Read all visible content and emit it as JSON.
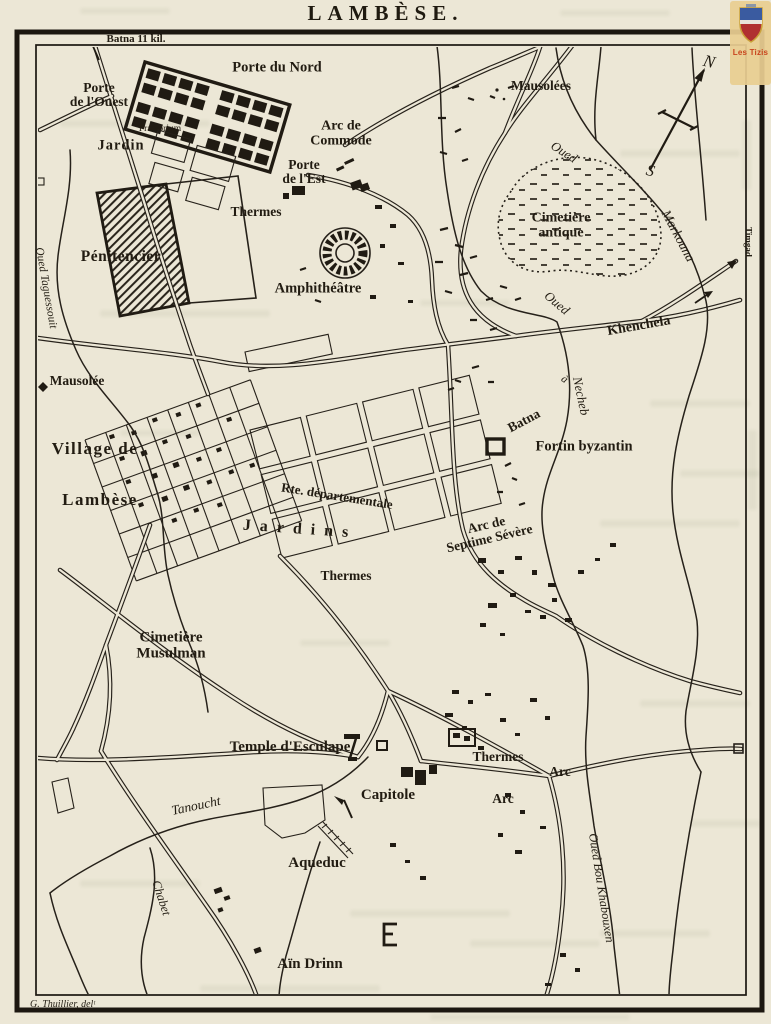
{
  "page": {
    "title": "LAMBÈSE.",
    "credit": "G. Thuillier, delᵗ",
    "watermark": {
      "text": "Les Tizis"
    },
    "colors": {
      "paper": "#ece7d6",
      "ink": "#26211a",
      "watermark_bg": "#e8ce91",
      "watermark_text": "#c8441c"
    }
  },
  "map": {
    "labels": [
      {
        "n": "batna-11kil",
        "t": "Batna 11 kil.",
        "x": 136,
        "y": 40,
        "s": 11,
        "r": 0
      },
      {
        "n": "porte-du-nord",
        "t": "Porte du Nord",
        "x": 277,
        "y": 68,
        "s": 14.5,
        "r": 0
      },
      {
        "n": "porte-de-l-ouest",
        "t": "Porte\nde l'Ouest",
        "x": 99,
        "y": 95,
        "s": 13.5,
        "r": 0
      },
      {
        "n": "mausolees",
        "t": "Mausolées",
        "x": 541,
        "y": 86,
        "s": 13.5,
        "r": 0
      },
      {
        "n": "arc-de-commode",
        "t": "Arc de\nCommode",
        "x": 341,
        "y": 134,
        "s": 14,
        "r": 0
      },
      {
        "n": "porte-de-l-est",
        "t": "Porte\nde l'Est",
        "x": 304,
        "y": 172,
        "s": 13.5,
        "r": 0
      },
      {
        "n": "praetorium",
        "t": "Praetorium",
        "x": 160,
        "y": 130,
        "s": 9.5,
        "r": 0,
        "w": 400
      },
      {
        "n": "jardin",
        "t": "Jardin",
        "x": 121,
        "y": 146,
        "s": 14.5,
        "r": 0,
        "ls": 1
      },
      {
        "n": "thermes-nord",
        "t": "Thermes",
        "x": 256,
        "y": 212,
        "s": 13.5,
        "r": 0
      },
      {
        "n": "penitencier",
        "t": "Pénitencier",
        "x": 121,
        "y": 257,
        "s": 15.5,
        "r": 0,
        "ls": 0.5
      },
      {
        "n": "amphitheatre",
        "t": "Amphithéâtre",
        "x": 318,
        "y": 289,
        "s": 14.5,
        "r": 0
      },
      {
        "n": "cimetiere-antique",
        "t": "Cimetière\nantique",
        "x": 561,
        "y": 226,
        "s": 14,
        "r": 0
      },
      {
        "n": "oued-markouna-oued",
        "t": "Oued",
        "x": 564,
        "y": 152,
        "s": 13,
        "r": 33,
        "i": true
      },
      {
        "n": "oued-markouna",
        "t": "Markouna",
        "x": 678,
        "y": 236,
        "s": 13.5,
        "r": 62,
        "i": true
      },
      {
        "n": "khenchela",
        "t": "Khenchela",
        "x": 639,
        "y": 327,
        "s": 14,
        "r": -10
      },
      {
        "n": "timgad",
        "t": "Timgad",
        "x": 748,
        "y": 242,
        "s": 9,
        "r": 90
      },
      {
        "n": "oued-necheb-oued",
        "t": "Oued",
        "x": 557,
        "y": 303,
        "s": 13,
        "r": 40,
        "i": true
      },
      {
        "n": "oued-necheb",
        "t": "Necheb",
        "x": 581,
        "y": 396,
        "s": 13,
        "r": 78,
        "i": true
      },
      {
        "n": "road-a",
        "t": "à",
        "x": 564,
        "y": 380,
        "s": 11,
        "r": 35,
        "i": true
      },
      {
        "n": "road-batna",
        "t": "Batna",
        "x": 524,
        "y": 421,
        "s": 13.5,
        "r": -28
      },
      {
        "n": "fortin-byzantin",
        "t": "Fortin byzantin",
        "x": 584,
        "y": 447,
        "s": 14.5,
        "r": 0
      },
      {
        "n": "oued-taguessouit",
        "t": "Oued Taguessouit",
        "x": 46,
        "y": 288,
        "s": 11.5,
        "r": 80,
        "i": true
      },
      {
        "n": "mausolee",
        "t": "Mausolée",
        "x": 77,
        "y": 381,
        "s": 13.5,
        "r": 0
      },
      {
        "n": "village-de",
        "t": "Village de",
        "x": 95,
        "y": 449,
        "s": 17,
        "r": 0,
        "ls": 1.5
      },
      {
        "n": "lambese-village",
        "t": "Lambèse",
        "x": 100,
        "y": 500,
        "s": 17,
        "r": 0,
        "ls": 1.5
      },
      {
        "n": "rte-departementale",
        "t": "Rte. départementale",
        "x": 337,
        "y": 496,
        "s": 13,
        "r": 9
      },
      {
        "n": "jardins",
        "t": "Jardins",
        "x": 300,
        "y": 530,
        "s": 16,
        "r": 4,
        "ls": 9
      },
      {
        "n": "arc-de-septime-severe",
        "t": "Arc de\nSeptime Sévère",
        "x": 488,
        "y": 532,
        "s": 13.5,
        "r": -13
      },
      {
        "n": "thermes-centre",
        "t": "Thermes",
        "x": 346,
        "y": 576,
        "s": 13.5,
        "r": 0
      },
      {
        "n": "cimetiere-musulman",
        "t": "Cimetière\nMusulman",
        "x": 171,
        "y": 646,
        "s": 15,
        "r": 0
      },
      {
        "n": "temple-esculape",
        "t": "Temple d'Esculape",
        "x": 290,
        "y": 748,
        "s": 15,
        "r": 0
      },
      {
        "n": "tanoucht",
        "t": "Tanoucht",
        "x": 196,
        "y": 806,
        "s": 13.5,
        "r": -12,
        "i": true
      },
      {
        "n": "capitole",
        "t": "Capitole",
        "x": 388,
        "y": 796,
        "s": 15,
        "r": 0
      },
      {
        "n": "aqueduc",
        "t": "Aqueduc",
        "x": 317,
        "y": 864,
        "s": 15,
        "r": 0
      },
      {
        "n": "thermes-sud",
        "t": "Thermes",
        "x": 498,
        "y": 757,
        "s": 13.5,
        "r": 0
      },
      {
        "n": "arc-nord",
        "t": "Arc",
        "x": 560,
        "y": 772,
        "s": 13.5,
        "r": 0
      },
      {
        "n": "arc-sud",
        "t": "Arc",
        "x": 503,
        "y": 799,
        "s": 13.5,
        "r": 0
      },
      {
        "n": "oued-bou-khabouxen",
        "t": "Oued Bou Khabouxen",
        "x": 601,
        "y": 888,
        "s": 12.5,
        "r": 81,
        "i": true
      },
      {
        "n": "chabet",
        "t": "Chabet",
        "x": 161,
        "y": 898,
        "s": 12.5,
        "r": 72,
        "i": true
      },
      {
        "n": "ain-drinn",
        "t": "Aïn Drinn",
        "x": 310,
        "y": 965,
        "s": 15,
        "r": 0
      },
      {
        "n": "compass-n",
        "t": "N",
        "x": 709,
        "y": 62,
        "s": 17,
        "r": 15,
        "i": true
      },
      {
        "n": "compass-s",
        "t": "S",
        "x": 650,
        "y": 172,
        "s": 16,
        "r": 15,
        "i": true
      }
    ]
  }
}
